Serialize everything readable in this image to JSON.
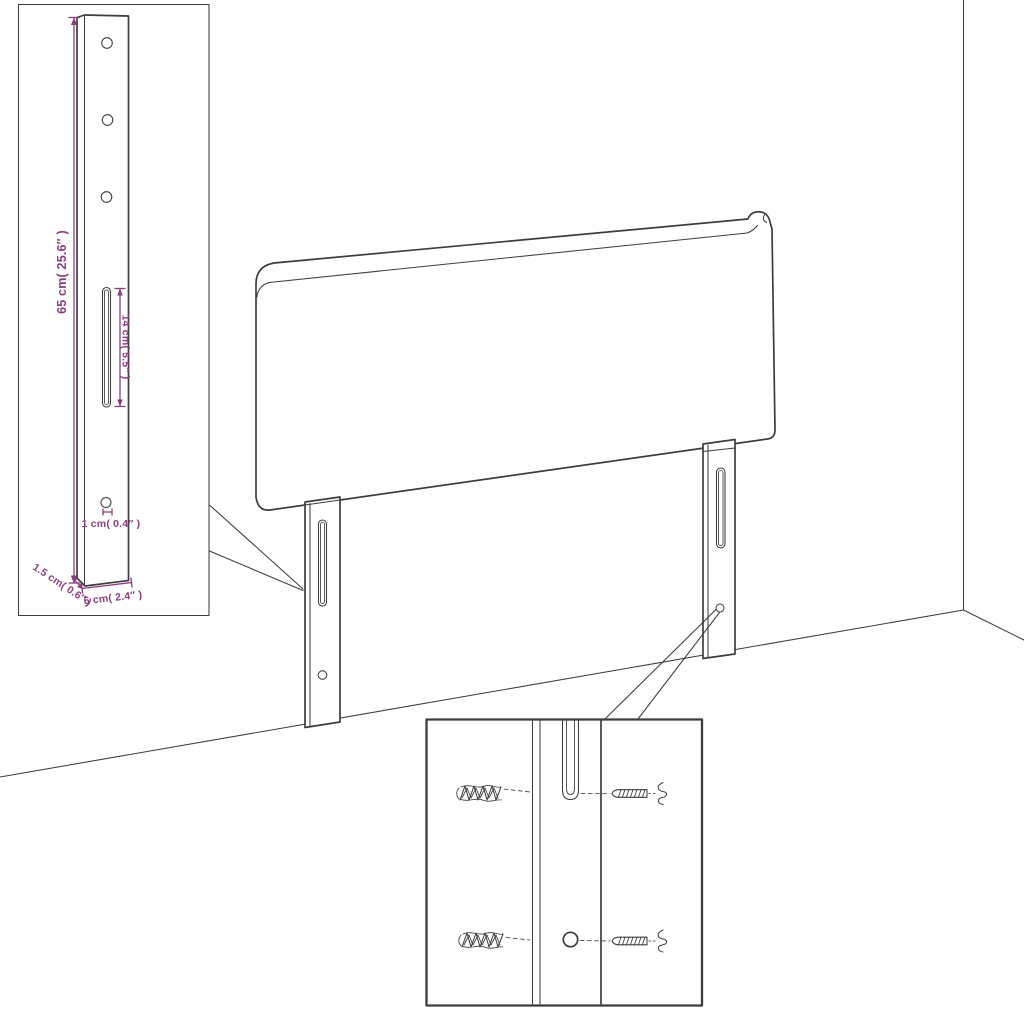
{
  "colors": {
    "background": "#ffffff",
    "line": "#3d3d3d",
    "dim": "#8a3e7e"
  },
  "dimensions": {
    "bracket_height": "65 cm( 25.6″ )",
    "slot_length": "14 cm( 5.5″ )",
    "hole_size": "1 cm( 0.4″ )",
    "thickness": "1.5 cm( 0.6″ )",
    "width": "6 cm( 2.4″ )"
  }
}
